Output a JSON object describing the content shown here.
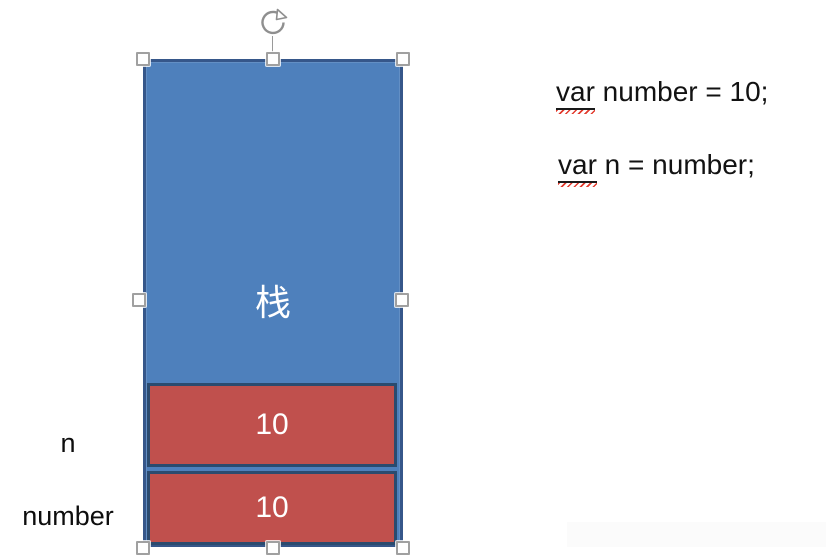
{
  "canvas": {
    "background": "#ffffff"
  },
  "stack": {
    "label": "栈",
    "fill": "#4E80BC",
    "border_color": "#36578A",
    "text_color": "#ffffff"
  },
  "slots": {
    "fill": "#C0504D",
    "border_color": "#2B4B6F",
    "text_color": "#ffffff",
    "items": [
      {
        "value": "10",
        "name_label": "n"
      },
      {
        "value": "10",
        "name_label": "number"
      }
    ]
  },
  "code": {
    "text_color": "#121212",
    "squiggle_color": "#E23B2E",
    "lines": [
      {
        "keyword": "var",
        "rest": " number = 10;"
      },
      {
        "keyword": "var",
        "rest": " n = number;"
      }
    ]
  },
  "selection": {
    "handle_fill": "#FEFEFE",
    "handle_border": "#A0A0A0",
    "rotate_handle_color": "#8F8F8F"
  }
}
